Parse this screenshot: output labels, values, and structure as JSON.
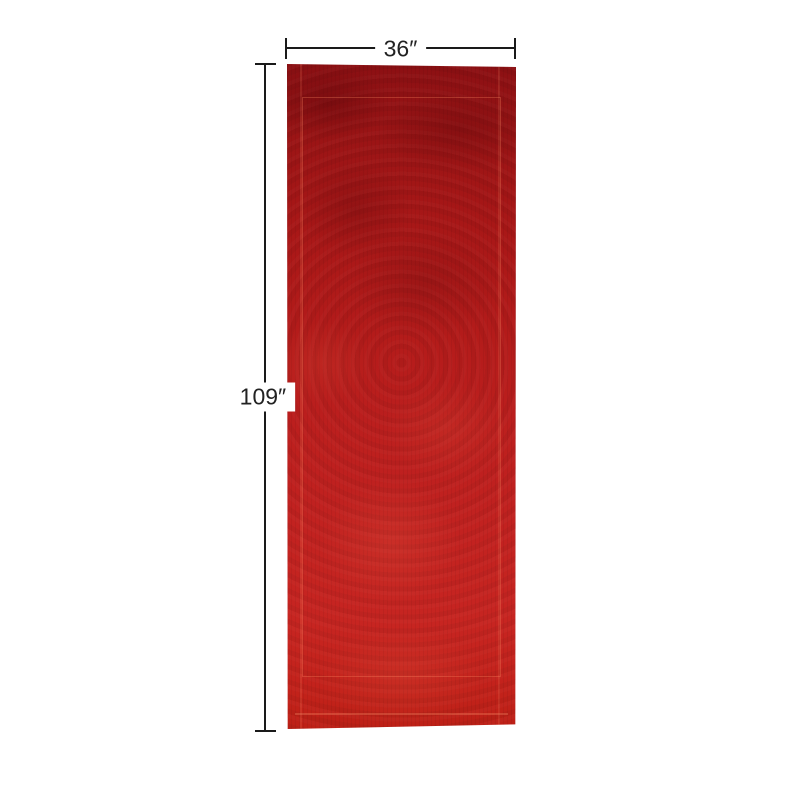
{
  "diagram": {
    "type": "product-dimension-diagram",
    "subject": "red overdyed runner rug, top view",
    "width_label": "36″",
    "height_label": "109″"
  },
  "colors": {
    "background": "#ffffff",
    "dimension_line": "#1a1a1a",
    "label_text": "#222222",
    "rug_top": "#8c1013",
    "rug_middle": "#b81c1b",
    "rug_bottom": "#c62420",
    "rug_pattern_highlight": "#e08064"
  }
}
